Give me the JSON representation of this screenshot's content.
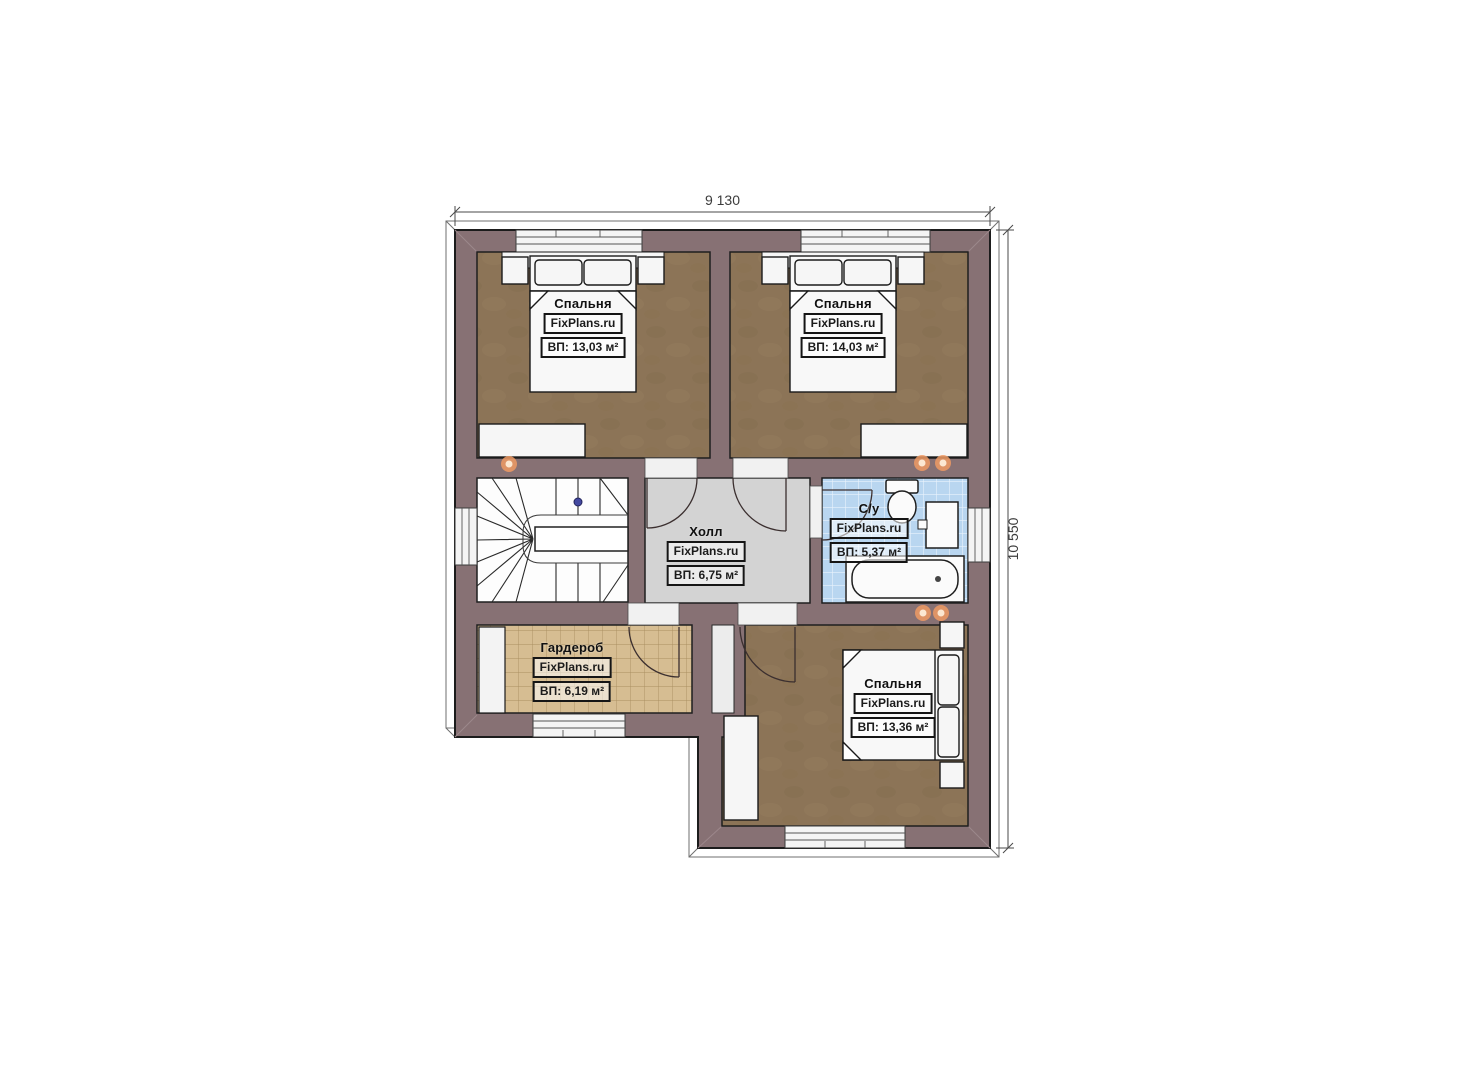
{
  "dimensions": {
    "width": "9 130",
    "height": "10 550"
  },
  "brand": "FixPlans.ru",
  "rooms": [
    {
      "id": "bedroom-top-left",
      "name": "Спальня",
      "brand": "FixPlans.ru",
      "area": "ВП: 13,03 м²"
    },
    {
      "id": "bedroom-top-right",
      "name": "Спальня",
      "brand": "FixPlans.ru",
      "area": "ВП: 14,03 м²"
    },
    {
      "id": "hall",
      "name": "Холл",
      "brand": "FixPlans.ru",
      "area": "ВП: 6,75 м²"
    },
    {
      "id": "bathroom",
      "name": "С/у",
      "brand": "FixPlans.ru",
      "area": "ВП: 5,37 м²"
    },
    {
      "id": "wardrobe",
      "name": "Гардероб",
      "brand": "FixPlans.ru",
      "area": "ВП: 6,19 м²"
    },
    {
      "id": "bedroom-bottom",
      "name": "Спальня",
      "brand": "FixPlans.ru",
      "area": "ВП: 13,36 м²"
    }
  ],
  "colors": {
    "wall": "#877174",
    "wood_floor": "#8c7457",
    "hall_floor": "#d3d3d3",
    "tile_blue": "#b9d6f0",
    "wardrobe_floor": "#d6bd92",
    "light_accent": "#ef9a64"
  }
}
